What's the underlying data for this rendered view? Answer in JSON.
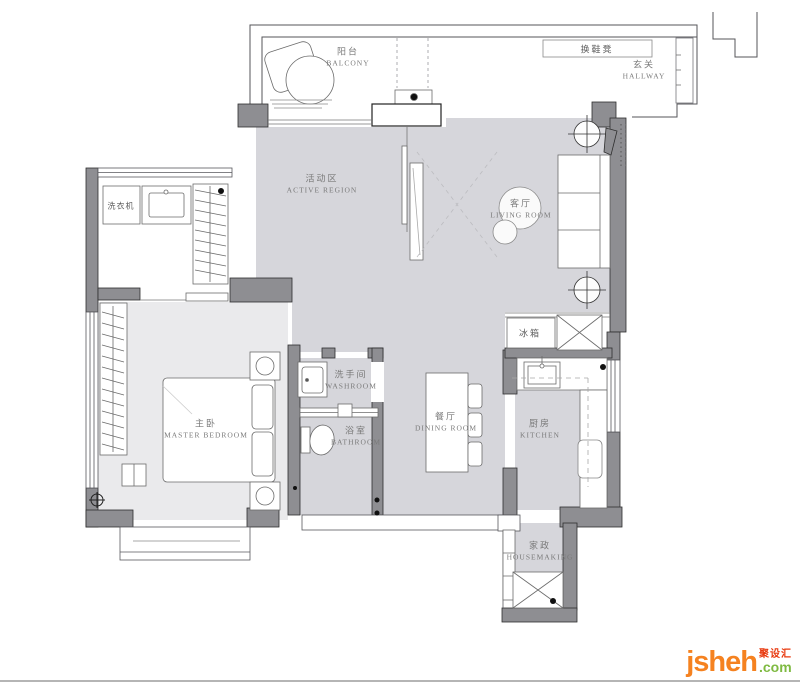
{
  "rooms": [
    {
      "id": "balcony",
      "zh": "阳台",
      "en": "BALCONY"
    },
    {
      "id": "hallway",
      "zh": "玄关",
      "en": "HALLWAY"
    },
    {
      "id": "active-region",
      "zh": "活动区",
      "en": "ACTIVE REGION"
    },
    {
      "id": "living-room",
      "zh": "客厅",
      "en": "LIVING ROOM"
    },
    {
      "id": "washroom",
      "zh": "洗手间",
      "en": "WASHROOM"
    },
    {
      "id": "bathroom",
      "zh": "浴室",
      "en": "BATHROOM"
    },
    {
      "id": "master-bedroom",
      "zh": "主卧",
      "en": "MASTER BEDROOM"
    },
    {
      "id": "dining-room",
      "zh": "餐厅",
      "en": "DINING ROOM"
    },
    {
      "id": "kitchen",
      "zh": "厨房",
      "en": "KITCHEN"
    },
    {
      "id": "housemaking",
      "zh": "家政",
      "en": "HOUSEMAKING"
    }
  ],
  "fixtures": [
    {
      "id": "shoe-bench",
      "label": "换鞋凳"
    },
    {
      "id": "washing-machine",
      "label": "洗衣机"
    },
    {
      "id": "fridge",
      "label": "冰箱"
    }
  ],
  "logo": {
    "name": "jsheh",
    "tld": ".com",
    "cn": "聚设汇",
    "colors": {
      "name": "#F58220",
      "tld": "#7FBA42",
      "cn": "#E8380D"
    }
  },
  "colors": {
    "floor": "#d6d6db",
    "bedroom_floor": "#eaeaec",
    "wall": "#8e8e92",
    "outline": "#2e2e2e"
  }
}
